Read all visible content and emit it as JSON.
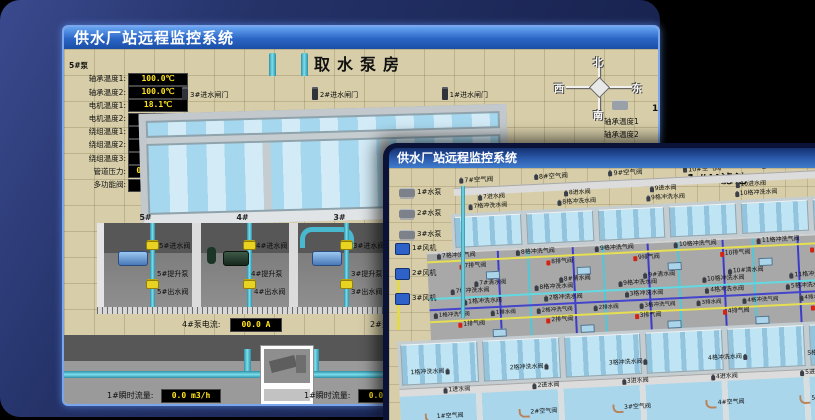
{
  "back": {
    "title": "供水厂站远程监控系统",
    "scene_title": "取水泵房",
    "panel": {
      "title": "5#泵",
      "rows": [
        {
          "label": "轴承温度1:",
          "value": "100.0℃"
        },
        {
          "label": "轴承温度2:",
          "value": "100.0℃"
        },
        {
          "label": "电机温度1:",
          "value": "18.1℃"
        },
        {
          "label": "电机温度2:",
          "value": "17.9℃"
        },
        {
          "label": "绕组温度1:",
          "value": "18.0℃"
        },
        {
          "label": "绕组温度2:",
          "value": "18.1℃"
        },
        {
          "label": "绕组温度3:",
          "value": "18.1℃"
        },
        {
          "label": "管道压力:",
          "value": "0.0007MPa"
        },
        {
          "label": "多功能阀:",
          "value": "0%"
        }
      ]
    },
    "compass": {
      "north": "北",
      "west": "西",
      "south": "南",
      "east": "东"
    },
    "right_panel": {
      "title": "1",
      "labels": [
        {
          "label": "轴承温度1"
        },
        {
          "label": "轴承温度2"
        }
      ]
    },
    "gates": [
      {
        "label": "3#进水闸门"
      },
      {
        "label": "2#进水闸门"
      },
      {
        "label": "1#进水闸门"
      }
    ],
    "bay_numbers": [
      {
        "no": "5#"
      },
      {
        "no": "4#"
      },
      {
        "no": "3#"
      }
    ],
    "bays": [
      {
        "inlet": "5#进水阀",
        "pump": "5#提升泵",
        "outlet": "5#出水阀"
      },
      {
        "inlet": "4#进水阀",
        "pump": "4#提升泵",
        "outlet": "4#出水阀"
      },
      {
        "inlet": "3#进水阀",
        "pump": "3#提升泵",
        "outlet": "3#出水阀"
      }
    ],
    "current_left": {
      "label": "4#泵电流:",
      "value": "00.0 A"
    },
    "current_right": {
      "label": "2#泵电流"
    },
    "flow_left": {
      "label": "1#瞬时流量:",
      "value": "0.0 m3/h"
    },
    "flow_right": {
      "label": "1#瞬时流量:",
      "value": "0.0 m3/h"
    }
  },
  "front": {
    "title": "供水厂站远程监控系统",
    "scene_title": "1#V滤池",
    "pumps": [
      {
        "label": "1#水泵"
      },
      {
        "label": "2#水泵"
      },
      {
        "label": "3#水泵"
      }
    ],
    "fans": [
      {
        "label": "1#风机"
      },
      {
        "label": "2#风机"
      },
      {
        "label": "3#风机"
      }
    ],
    "far": {
      "air": [
        {
          "label": "7#空气阀"
        },
        {
          "label": "8#空气阀"
        },
        {
          "label": "9#空气阀"
        },
        {
          "label": "10#空气阀"
        },
        {
          "label": "11#空气阀"
        },
        {
          "label": "12#空气阀"
        }
      ],
      "inlet": [
        {
          "label": "7进水阀"
        },
        {
          "label": "8进水阀"
        },
        {
          "label": "9进水阀"
        },
        {
          "label": "10进水阀"
        },
        {
          "label": "11进水阀"
        }
      ],
      "wash": [
        {
          "label": "7格冲洗水阀"
        },
        {
          "label": "8格冲洗水阀"
        },
        {
          "label": "9格冲洗水阀"
        },
        {
          "label": "10格冲洗水阀"
        },
        {
          "label": "11格冲洗水阀"
        }
      ]
    },
    "gal": {
      "washair": [
        {
          "label": "7格冲洗气阀"
        },
        {
          "label": "8格冲洗气阀"
        },
        {
          "label": "9格冲洗气阀"
        },
        {
          "label": "10格冲洗气阀"
        },
        {
          "label": "11格冲洗气阀"
        },
        {
          "label": "12格冲洗气阀"
        }
      ],
      "exhaust_far": [
        {
          "label": "7排气阀"
        },
        {
          "label": "8排气阀"
        },
        {
          "label": "9排气阀"
        },
        {
          "label": "10排气阀"
        },
        {
          "label": "11排气阀"
        }
      ],
      "clear_far": [
        {
          "label": "7#清水阀"
        },
        {
          "label": "8#清水阀"
        },
        {
          "label": "9#清水阀"
        },
        {
          "label": "10#清水阀"
        },
        {
          "label": "11#清水阀"
        }
      ],
      "wash_far": [
        {
          "label": "7格冲洗水阀"
        },
        {
          "label": "8格冲洗水阀"
        },
        {
          "label": "9格冲洗水阀"
        },
        {
          "label": "10格冲洗水阀"
        },
        {
          "label": "11格冲洗水阀"
        }
      ],
      "wash_near": [
        {
          "label": "1格冲洗水阀"
        },
        {
          "label": "2格冲洗水阀"
        },
        {
          "label": "3格冲洗水阀"
        },
        {
          "label": "4格冲洗水阀"
        },
        {
          "label": "5格冲洗水阀"
        }
      ],
      "drain": [
        {
          "label": "1格冲洗气阀"
        },
        {
          "label": "1排水阀"
        },
        {
          "label": "2格冲洗气阀"
        },
        {
          "label": "2排水阀"
        },
        {
          "label": "3格冲洗气阀"
        },
        {
          "label": "3排水阀"
        },
        {
          "label": "4格冲洗气阀"
        },
        {
          "label": "4排水阀"
        },
        {
          "label": "5格冲洗气阀"
        }
      ],
      "exhaust_near": [
        {
          "label": "1排气阀"
        },
        {
          "label": "2排气阀"
        },
        {
          "label": "3排气阀"
        },
        {
          "label": "4排气阀"
        },
        {
          "label": "5排气阀"
        }
      ]
    },
    "near": {
      "wash": [
        {
          "label": "1格冲洗水阀"
        },
        {
          "label": "2格冲洗水阀"
        },
        {
          "label": "3格冲洗水阀"
        },
        {
          "label": "4格冲洗水阀"
        },
        {
          "label": "5格冲洗水阀"
        }
      ],
      "inlet": [
        {
          "label": "1进水阀"
        },
        {
          "label": "2进水阀"
        },
        {
          "label": "3进水阀"
        },
        {
          "label": "4进水阀"
        },
        {
          "label": "5进水阀"
        }
      ],
      "air": [
        {
          "label": "1#空气阀"
        },
        {
          "label": "2#空气阀"
        },
        {
          "label": "3#空气阀"
        },
        {
          "label": "4#空气阀"
        },
        {
          "label": "5#空气阀"
        }
      ]
    }
  },
  "colors": {
    "titlebar_top": "#66a4f2",
    "titlebar_bottom": "#1b4fa6",
    "display_text": "#ffe41a",
    "pipe_cyan": "#49b9cf",
    "valve_yellow": "#e8d322",
    "water": "#a5d7ee",
    "alarm_red": "#d42310"
  }
}
